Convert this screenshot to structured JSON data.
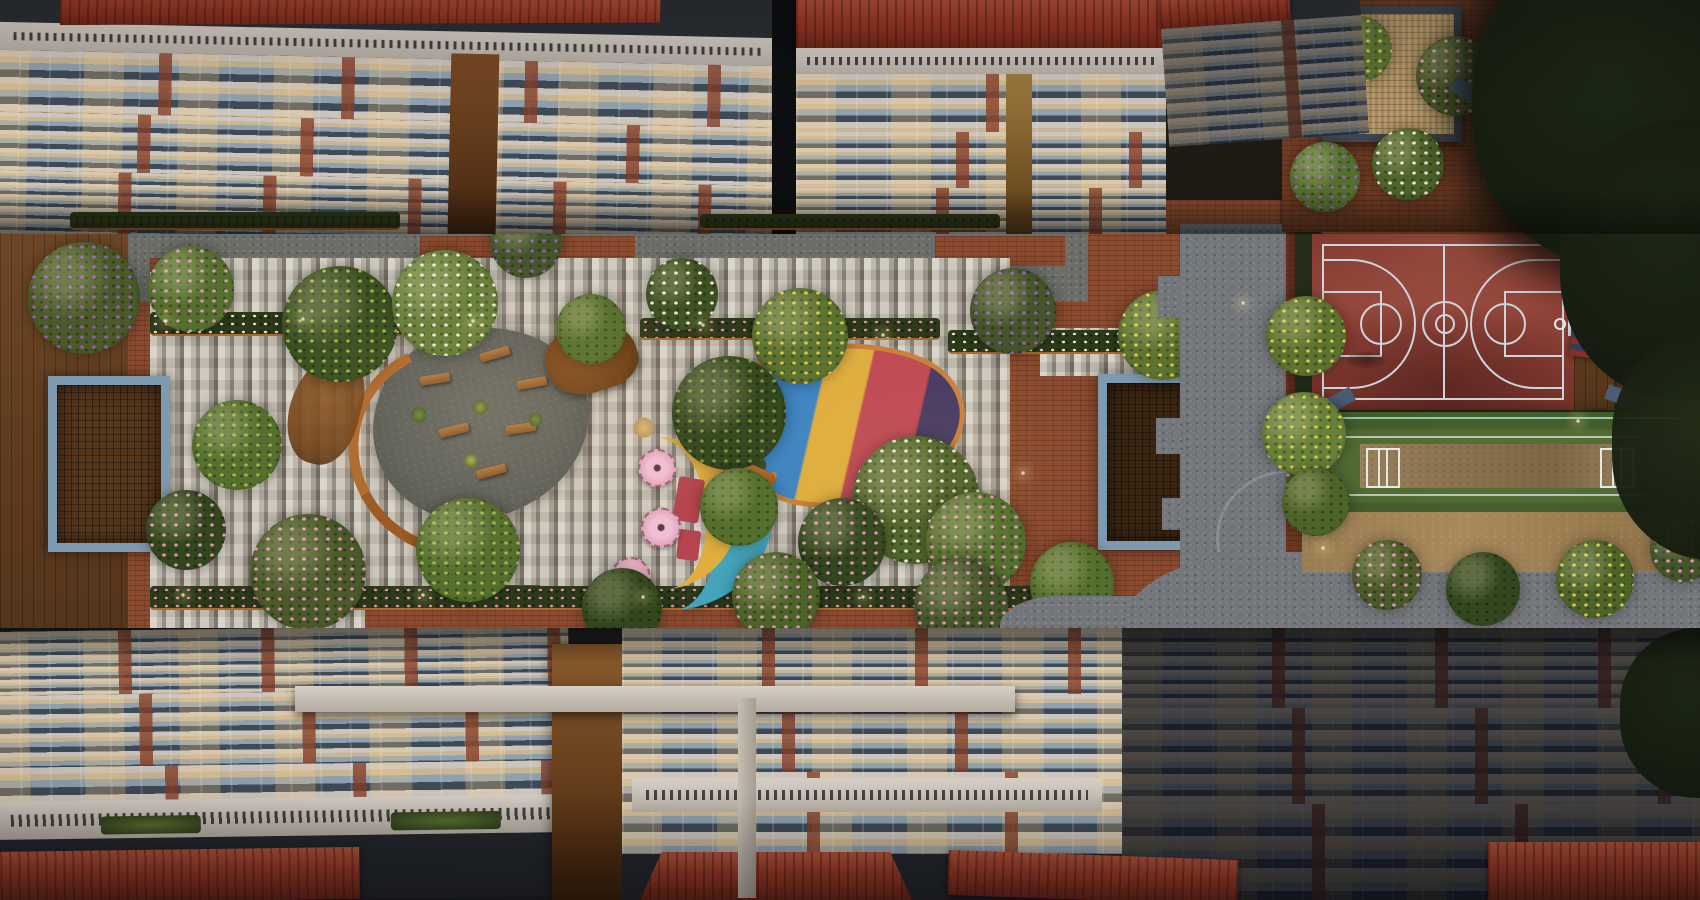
{
  "scene": {
    "title": "Top-down aerial dusk rendering of a residential apartment complex courtyard",
    "description": "Bird's-eye dusk view looking straight down between apartment towers onto a landscaped podium courtyard with mosaic paving, flowering trees, two blue-framed timber pergolas, a circular timber-bench seating plaza, a fish-shaped multicolour play mound, a teal crescent toddler play strip with spinner discs, a maroon basketball court, a green cricket practice pitch, bleachers, grey cobble pathways and a timber roof-garden pavilion.",
    "view": "top-down aerial",
    "time_of_day": "dusk",
    "style": "photorealistic architectural rendering"
  },
  "palette": {
    "brick": "#8a4a2e",
    "brickDim": "#6d3722",
    "brickDark": "#52291a",
    "cobble": "#73767b",
    "cobbleDark": "#595c61",
    "deck": "#6e4726",
    "deckDark": "#53341b",
    "plaza": "#5f615b",
    "copper": "#b06a2e",
    "woodWall": "#6e4017",
    "pergFrame": "#7e9ab0",
    "pergWood": "#54361d",
    "slab": "#ccc5bd",
    "glass": "#8fa0ae",
    "glassDark": "#3e4a56",
    "glassLit": "#c7b696",
    "roof": "#9c3a26",
    "roofHi": "#b4543a",
    "roofDark": "#6e2517",
    "g1": "#3f5224",
    "g2": "#5a7030",
    "g3": "#73883c",
    "gDark": "#2c3a1a",
    "night": "#141b0f",
    "flPink": "#d795b4",
    "flPurple": "#8e5fae",
    "flYellow": "#d3c84b",
    "flWhite": "#e8e4d5",
    "playTeal": "#45a4ba",
    "playYellow": "#dfae3f",
    "playRed": "#b5454e",
    "playBlue": "#3e84c2",
    "playNavy": "#463a63",
    "playPink": "#e3a7bd",
    "bbCourt": "#8c3a31",
    "bbLine": "#ccd4dc",
    "bbGreen": "#232d18",
    "crGreen": "#48652e",
    "crLane": "#5d7a38",
    "pitchTan": "#8d7350",
    "lineTeal": "#a8ddd3",
    "sand": "#a8895c",
    "bleachRed": "#8a2c2c",
    "bleachBlue": "#2e3d5e"
  },
  "regions": {
    "top_buildings": {
      "label": "apartment towers seen from above (top edge)",
      "features": [
        "red clay tile roofs",
        "white balcony slab rows receding with perspective",
        "blue-grey glazing",
        "warm lit windows",
        "brick piers",
        "louvred parapets",
        "hedge planters at podium base"
      ]
    },
    "bottom_buildings": {
      "label": "apartment towers seen from above (bottom edge)",
      "features": [
        "red clay tile roofs",
        "dim balcony rows",
        "white connecting sky-bridge beam",
        "timber service shaft",
        "terrace gardens on parapet"
      ]
    },
    "courtyard": {
      "label": "central landscaped podium courtyard",
      "paving": [
        "grey-white mosaic strip paving",
        "terracotta brick paving",
        "timber deck (left edge)"
      ],
      "features": [
        "left blue-framed pergola",
        "right blue-framed pergola",
        "circular seating plaza with timber benches",
        "curved copper-timber edge walls",
        "flowering trees (pink, purple, yellow, white)",
        "hedge planters with downlights"
      ]
    },
    "play_areas": {
      "fish_mound": {
        "label": "fish-shaped play mound",
        "colors": [
          "blue",
          "yellow",
          "crimson",
          "navy"
        ],
        "edge": "orange timber rim"
      },
      "toddler_area": {
        "label": "teal crescent toddler play strip",
        "colors": [
          "teal",
          "yellow",
          "red"
        ],
        "spinner_discs": 3
      }
    },
    "sports_zone": {
      "basketball_court": {
        "surface": "maroon acrylic",
        "lines": "pale blue-white",
        "features": [
          "centre circle",
          "two free-throw keys",
          "three-point arcs",
          "two hoops with backboards",
          "painted court logo (illegible)",
          "dark hedge surround",
          "corner mats"
        ]
      },
      "cricket_pitch": {
        "surface": "green turf",
        "pitch": "tan central strip",
        "features": [
          "white crease markings at both ends",
          "teal boundary lines"
        ]
      },
      "bleachers": {
        "label": "red and blue striped bleacher benches"
      },
      "side_deck": "timber deck beside court"
    },
    "paths": {
      "cobble_path": "grey stone cobble path bordering the sports zone and curving around planting"
    },
    "garden_top_right": {
      "label": "roof garden with square timber pavilion, brick paving and dense dark tree canopy"
    }
  }
}
